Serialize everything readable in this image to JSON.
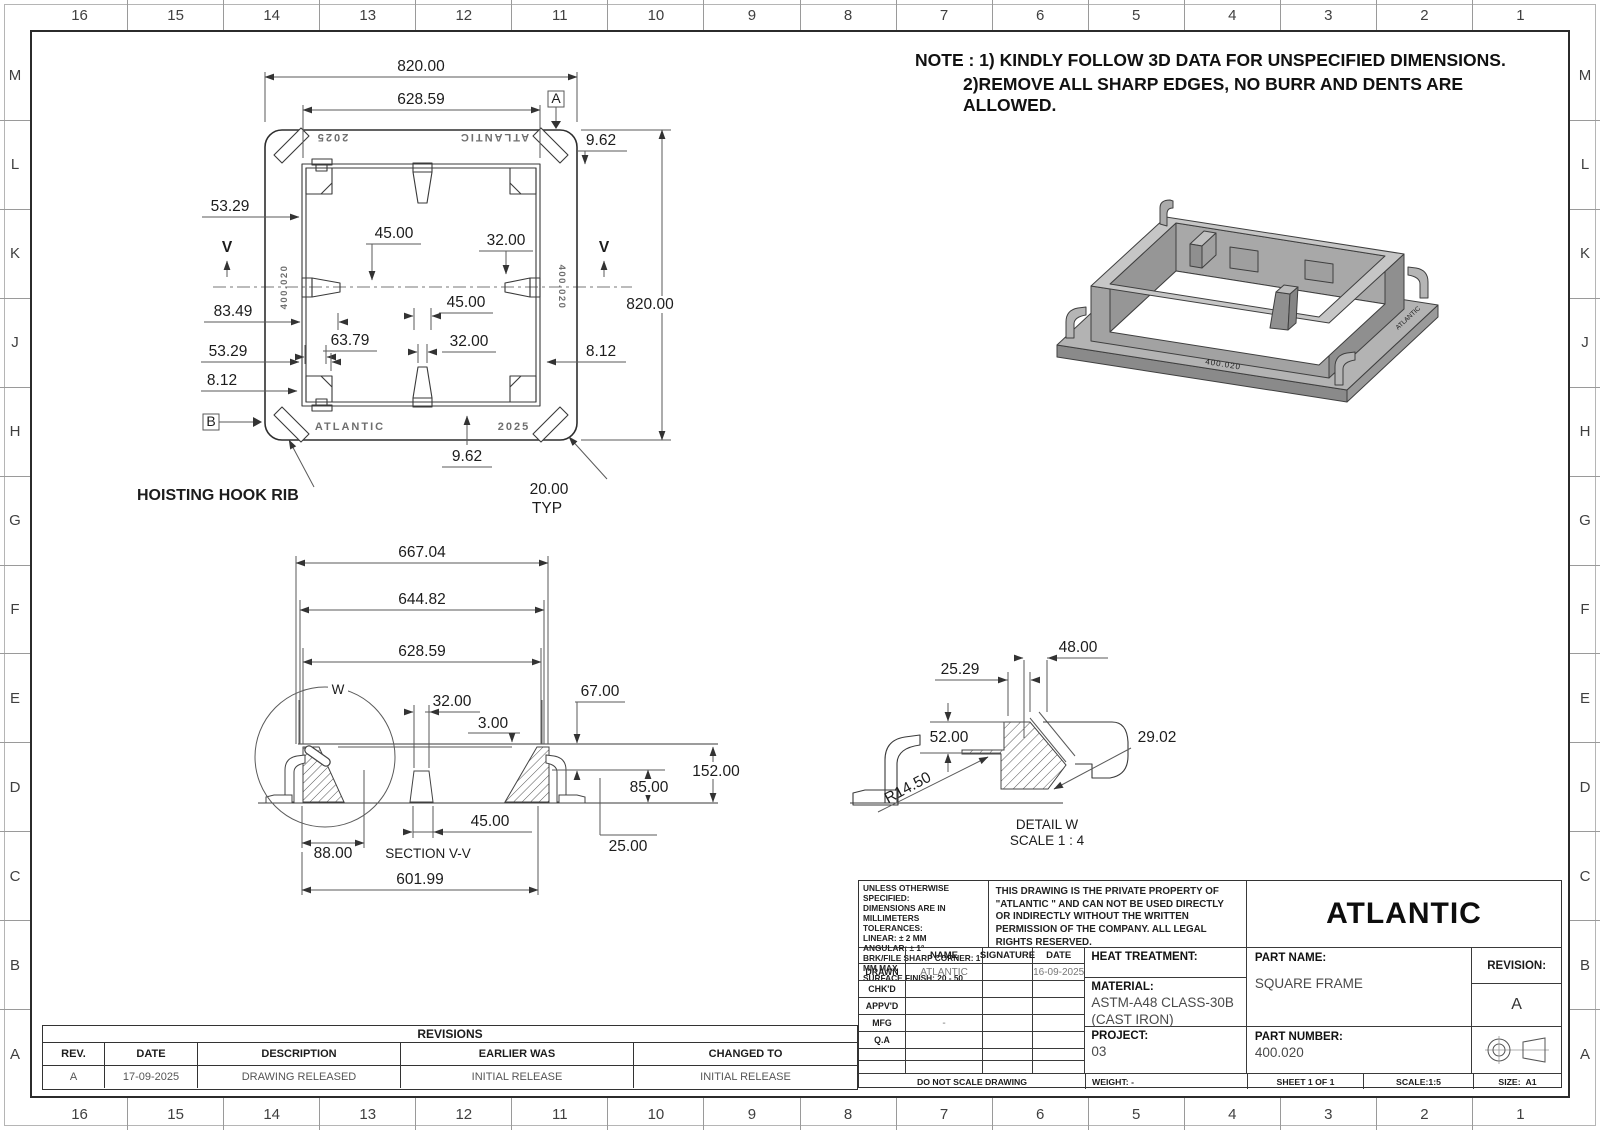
{
  "sheet": {
    "zone_cols": [
      "16",
      "15",
      "14",
      "13",
      "12",
      "11",
      "10",
      "9",
      "8",
      "7",
      "6",
      "5",
      "4",
      "3",
      "2",
      "1"
    ],
    "zone_rows": [
      "M",
      "L",
      "K",
      "J",
      "H",
      "G",
      "F",
      "E",
      "D",
      "C",
      "B",
      "A"
    ]
  },
  "notes": {
    "line1": "NOTE : 1) KINDLY FOLLOW 3D DATA FOR UNSPECIFIED DIMENSIONS.",
    "line2": "2)REMOVE ALL SHARP EDGES, NO BURR AND DENTS ARE ALLOWED."
  },
  "top_view": {
    "d820t": "820.00",
    "d628": "628.59",
    "d962t": "9.62",
    "d820r": "820.00",
    "d5329a": "53.29",
    "d45a": "45.00",
    "d32a": "32.00",
    "d8349": "83.49",
    "d6379": "63.79",
    "d45b": "45.00",
    "d32b": "32.00",
    "d5329b": "53.29",
    "d812l": "8.12",
    "d812r": "8.12",
    "d962b": "9.62",
    "d20": "20.00",
    "typ": "TYP",
    "v": "V",
    "datum_a": "A",
    "datum_b": "B",
    "mark_2025": "2025",
    "mark_atlantic": "ATLANTIC",
    "mark_part": "400.020",
    "hoist": "HOISTING HOOK RIB"
  },
  "section_view": {
    "title": "SECTION V-V",
    "w": "W",
    "s667": "667.04",
    "s644": "644.82",
    "s628": "628.59",
    "s32": "32.00",
    "s3": "3.00",
    "s67": "67.00",
    "s152": "152.00",
    "s85": "85.00",
    "s45": "45.00",
    "s88": "88.00",
    "s25": "25.00",
    "s601": "601.99"
  },
  "detail_view": {
    "title": "DETAIL W",
    "scale": "SCALE 1 : 4",
    "d48": "48.00",
    "d2529": "25.29",
    "d52": "52.00",
    "d2902": "29.02",
    "r145": "R14.50"
  },
  "iso_view": {
    "marking1": "400.020",
    "marking2": "ATLANTIC"
  },
  "title_block": {
    "company": "ATLANTIC",
    "tolerance_note": [
      "UNLESS OTHERWISE SPECIFIED:",
      "DIMENSIONS ARE IN MILLIMETERS",
      "TOLERANCES:",
      "LINEAR: ± 2 MM",
      "ANGULAR: ± 1°",
      "BRK/FILE SHARP CORNER: 1 MM MAX",
      "SURFACE FINISH: 20 - 50"
    ],
    "property_note": "THIS DRAWING IS THE PRIVATE PROPERTY OF \"ATLANTIC \" AND CAN NOT BE USED DIRECTLY OR INDIRECTLY WITHOUT THE WRITTEN PERMISSION  OF THE COMPANY. ALL LEGAL RIGHTS RESERVED.",
    "sign_table": {
      "headers": [
        "NAME",
        "SIGNATURE",
        "DATE"
      ],
      "rows": [
        {
          "label": "DRAWN",
          "name": "ATLANTIC",
          "signature": "",
          "date": "16-09-2025"
        },
        {
          "label": "CHK'D",
          "name": "",
          "signature": "",
          "date": ""
        },
        {
          "label": "APPV'D",
          "name": "",
          "signature": "",
          "date": ""
        },
        {
          "label": "MFG",
          "name": "-",
          "signature": "",
          "date": ""
        },
        {
          "label": "Q.A",
          "name": "",
          "signature": "",
          "date": ""
        }
      ]
    },
    "heat_treatment_label": "HEAT TREATMENT:",
    "material_label": "MATERIAL:",
    "material_value_1": "ASTM-A48 CLASS-30B",
    "material_value_2": "(CAST IRON)",
    "project_label": "PROJECT:",
    "project_value": "03",
    "part_name_label": "PART NAME:",
    "part_name_value": "SQUARE FRAME",
    "part_number_label": "PART NUMBER:",
    "part_number_value": "400.020",
    "revision_label": "REVISION:",
    "revision_value": "A",
    "do_not_scale": "DO NOT SCALE DRAWING",
    "weight": "WEIGHT: -",
    "sheet_no": "SHEET 1 OF 1",
    "scale": "SCALE:1:5",
    "size_label": "SIZE:",
    "size_value": "A1"
  },
  "revisions": {
    "title": "REVISIONS",
    "headers": [
      "REV.",
      "DATE",
      "DESCRIPTION",
      "EARLIER WAS",
      "CHANGED TO"
    ],
    "rows": [
      [
        "A",
        "17-09-2025",
        "DRAWING RELEASED",
        "INITIAL RELEASE",
        "INITIAL RELEASE"
      ]
    ]
  }
}
